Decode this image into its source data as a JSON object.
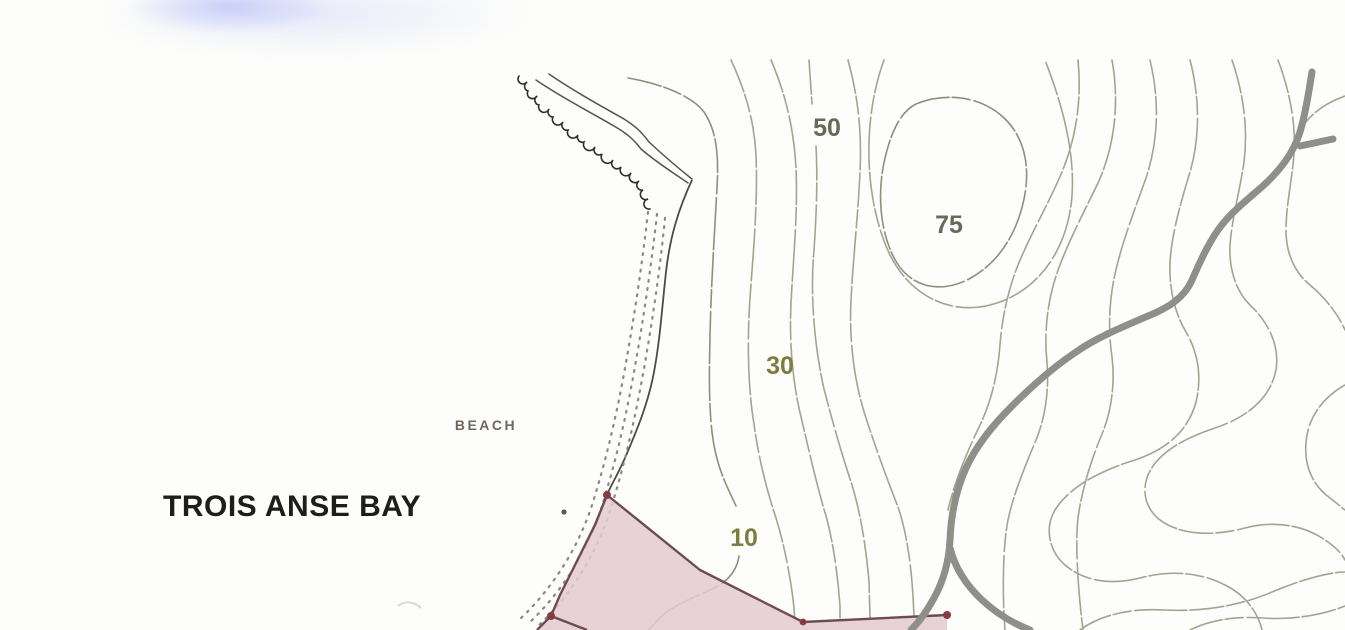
{
  "map": {
    "labels": {
      "bay": "TROIS ANSE BAY",
      "beach": "BEACH",
      "contour_10": "10",
      "contour_30": "30",
      "contour_50": "50",
      "contour_75": "75"
    },
    "colors": {
      "map-bg": "#fdfdfb",
      "contour-line": "#a3a391",
      "contour-dark": "#8e8e7c",
      "contour-label": "#7d7d42",
      "contour-label-gray": "#69695a",
      "coast-ink": "#2e2e2a",
      "beach-stipple": "#8a8a80",
      "road-gray": "#8f8f89",
      "parcel-fill": "#e3cbcf",
      "parcel-stroke": "#6d4c50",
      "parcel-dot": "#8a3b40",
      "bay-label": "#1d1d1b",
      "beach-label": "#6f675c"
    }
  }
}
